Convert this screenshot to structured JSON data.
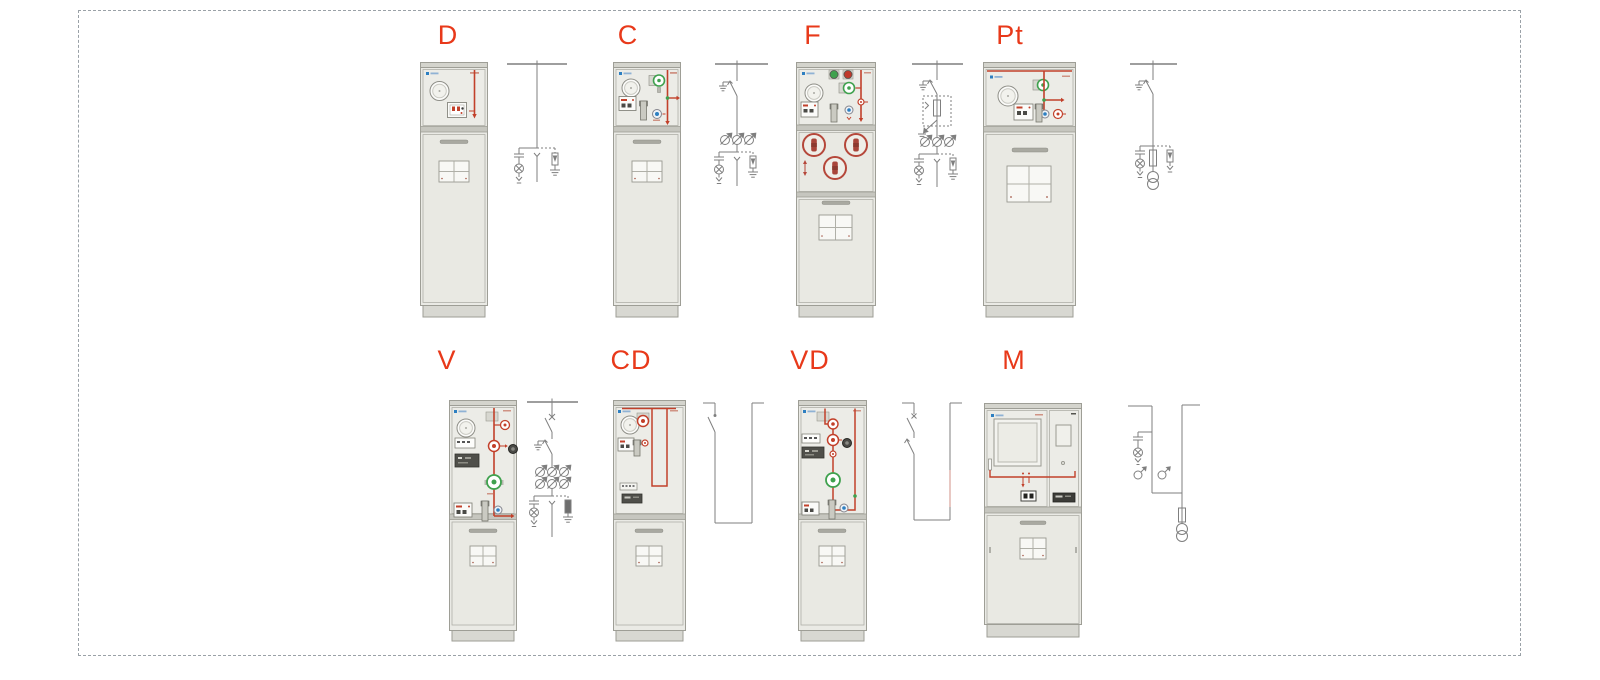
{
  "page": {
    "background": "#ffffff",
    "frame_border_color": "#9aa1a7"
  },
  "colors": {
    "label_red": "#e8391a",
    "mimic_red": "#c2402a",
    "fuse_ring_red": "#b5473a",
    "indicator_green": "#3fa14e",
    "indicator_blue": "#2d7fc1",
    "diagram_gray": "#7f7f7f",
    "cabinet_body": "#eaeae5"
  },
  "rows": [
    {
      "units": [
        {
          "label": "D"
        },
        {
          "label": "C"
        },
        {
          "label": "F"
        },
        {
          "label": "Pt"
        }
      ]
    },
    {
      "units": [
        {
          "label": "V"
        },
        {
          "label": "CD"
        },
        {
          "label": "VD"
        },
        {
          "label": "M"
        }
      ]
    }
  ]
}
